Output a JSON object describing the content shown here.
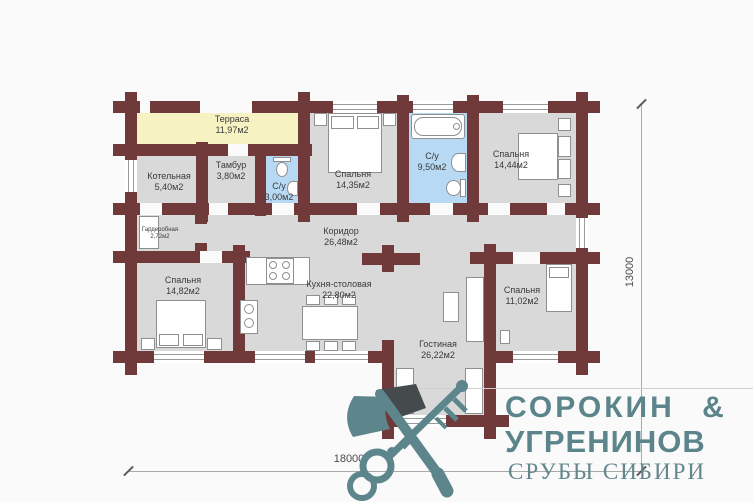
{
  "plan": {
    "rooms": [
      {
        "name": "Терраса",
        "area": "11,97м2"
      },
      {
        "name": "Котельная",
        "area": "5,40м2"
      },
      {
        "name": "Тамбур",
        "area": "3,80м2"
      },
      {
        "name": "С/у",
        "area": "3,00м2"
      },
      {
        "name": "Спальня",
        "area": "14,35м2"
      },
      {
        "name": "С/у",
        "area": "9,50м2"
      },
      {
        "name": "Спальня",
        "area": "14,44м2"
      },
      {
        "name": "Коридор",
        "area": "26,48м2"
      },
      {
        "name": "Гардеробная",
        "area": "2,72м2"
      },
      {
        "name": "Спальня",
        "area": "14,82м2"
      },
      {
        "name": "Кухня-столовая",
        "area": "22,80м2"
      },
      {
        "name": "Гостиная",
        "area": "26,22м2"
      },
      {
        "name": "Спальня",
        "area": "11,02м2"
      }
    ],
    "dimensions": {
      "width_label": "18000",
      "height_label": "13000"
    }
  },
  "logo": {
    "brand_line1": "СОРОКИН &",
    "brand_line2": "УГРЕНИНОВ",
    "tagline": "СРУБЫ СИБИРИ"
  },
  "colors": {
    "wall": "#713a3a",
    "room_fill": "#d9d9d9",
    "terrace_fill": "#f6f2c2",
    "bath_fill": "#b7d9f3",
    "logo_teal": "#5d868c"
  }
}
